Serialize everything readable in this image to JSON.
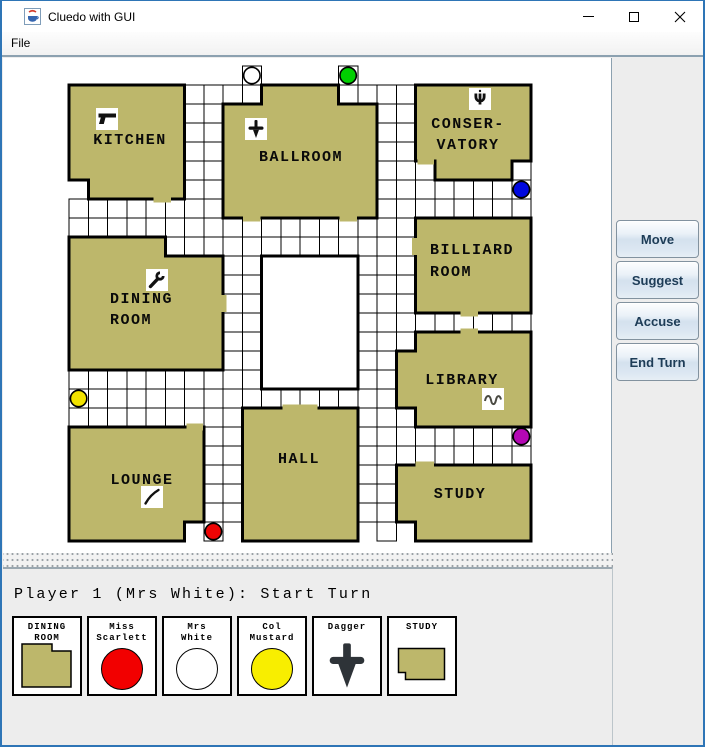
{
  "window": {
    "title": "Cluedo with GUI"
  },
  "menu": {
    "items": [
      {
        "label": "File"
      }
    ]
  },
  "action_panel": {
    "buttons": [
      {
        "label": "Move"
      },
      {
        "label": "Suggest"
      },
      {
        "label": "Accuse"
      },
      {
        "label": "End Turn"
      }
    ]
  },
  "status_bar": {
    "text": "Player 1 (Mrs White): Start Turn"
  },
  "colors": {
    "room_fill": "#bdb76b",
    "grid_line": "#000000",
    "window_border": "#2e75b6",
    "button_text": "#1d3c57",
    "dagger_card": "#2e3338"
  },
  "board": {
    "cell_size": [
      19.25,
      19.0
    ],
    "origin_svg": [
      66,
      8
    ],
    "corridor_rows": {
      "0": [
        [
          9,
          9
        ],
        [
          14,
          14
        ]
      ],
      "1": [
        [
          6,
          9
        ],
        [
          14,
          17
        ]
      ],
      "2": [
        [
          6,
          7
        ],
        [
          16,
          17
        ]
      ],
      "3": [
        [
          6,
          7
        ],
        [
          16,
          17
        ]
      ],
      "4": [
        [
          6,
          7
        ],
        [
          16,
          17
        ]
      ],
      "5": [
        [
          6,
          7
        ],
        [
          16,
          18
        ],
        [
          23,
          23
        ]
      ],
      "6": [
        [
          6,
          7
        ],
        [
          16,
          23
        ]
      ],
      "7": [
        [
          0,
          7
        ],
        [
          16,
          23
        ]
      ],
      "8": [
        [
          0,
          17
        ]
      ],
      "9": [
        [
          5,
          17
        ]
      ],
      "10": [
        [
          8,
          9
        ],
        [
          15,
          17
        ]
      ],
      "11": [
        [
          8,
          9
        ],
        [
          15,
          17
        ]
      ],
      "12": [
        [
          8,
          9
        ],
        [
          15,
          17
        ]
      ],
      "13": [
        [
          8,
          9
        ],
        [
          15,
          23
        ]
      ],
      "14": [
        [
          8,
          9
        ],
        [
          15,
          17
        ]
      ],
      "15": [
        [
          8,
          9
        ],
        [
          15,
          16
        ]
      ],
      "16": [
        [
          0,
          9
        ],
        [
          15,
          16
        ]
      ],
      "17": [
        [
          0,
          16
        ]
      ],
      "18": [
        [
          0,
          8
        ],
        [
          15,
          17
        ]
      ],
      "19": [
        [
          7,
          8
        ],
        [
          15,
          23
        ]
      ],
      "20": [
        [
          7,
          8
        ],
        [
          15,
          23
        ]
      ],
      "21": [
        [
          7,
          8
        ],
        [
          15,
          16
        ]
      ],
      "22": [
        [
          7,
          8
        ],
        [
          15,
          16
        ]
      ],
      "23": [
        [
          7,
          8
        ],
        [
          15,
          16
        ]
      ],
      "24": [
        [
          7,
          7
        ],
        [
          16,
          16
        ]
      ]
    },
    "rooms": [
      {
        "id": "kitchen",
        "label": [
          "KITCHEN"
        ],
        "label_pos": [
          127,
          86
        ],
        "anchor": "middle",
        "line_h": 21,
        "icon": {
          "name": "revolver",
          "cx": 104,
          "cy": 61
        },
        "poly": [
          [
            0,
            1
          ],
          [
            6,
            1
          ],
          [
            6,
            7
          ],
          [
            1,
            7
          ],
          [
            1,
            6
          ],
          [
            0,
            6
          ]
        ]
      },
      {
        "id": "ballroom",
        "label": [
          "BALLROOM"
        ],
        "label_pos": [
          298,
          103
        ],
        "anchor": "middle",
        "line_h": 21,
        "icon": {
          "name": "dagger",
          "cx": 253,
          "cy": 71
        },
        "poly": [
          [
            10,
            1
          ],
          [
            14,
            1
          ],
          [
            14,
            2
          ],
          [
            16,
            2
          ],
          [
            16,
            8
          ],
          [
            8,
            8
          ],
          [
            8,
            2
          ],
          [
            10,
            2
          ]
        ]
      },
      {
        "id": "conservatory",
        "label": [
          "CONSER-",
          "VATORY"
        ],
        "label_pos": [
          465,
          70
        ],
        "anchor": "middle",
        "line_h": 21,
        "icon": {
          "name": "candlestick",
          "cx": 477,
          "cy": 41
        },
        "poly": [
          [
            18,
            1
          ],
          [
            24,
            1
          ],
          [
            24,
            5
          ],
          [
            23,
            5
          ],
          [
            23,
            6
          ],
          [
            19,
            6
          ],
          [
            19,
            5
          ],
          [
            18,
            5
          ]
        ]
      },
      {
        "id": "dining-room",
        "label": [
          "DINING",
          "ROOM"
        ],
        "label_pos": [
          107,
          245
        ],
        "anchor": "start",
        "line_h": 21,
        "icon": {
          "name": "wrench",
          "cx": 154,
          "cy": 222
        },
        "poly": [
          [
            0,
            9
          ],
          [
            5,
            9
          ],
          [
            5,
            10
          ],
          [
            8,
            10
          ],
          [
            8,
            16
          ],
          [
            0,
            16
          ]
        ]
      },
      {
        "id": "billiard-room",
        "label": [
          "BILLIARD",
          "ROOM"
        ],
        "label_pos": [
          427,
          196
        ],
        "anchor": "start",
        "line_h": 22,
        "icon": null,
        "poly": [
          [
            18,
            8
          ],
          [
            24,
            8
          ],
          [
            24,
            13
          ],
          [
            18,
            13
          ]
        ]
      },
      {
        "id": "library",
        "label": [
          "LIBRARY"
        ],
        "label_pos": [
          459,
          326
        ],
        "anchor": "middle",
        "line_h": 21,
        "icon": {
          "name": "rope",
          "cx": 490,
          "cy": 341
        },
        "poly": [
          [
            18,
            14
          ],
          [
            24,
            14
          ],
          [
            24,
            19
          ],
          [
            18,
            19
          ],
          [
            18,
            18
          ],
          [
            17,
            18
          ],
          [
            17,
            15
          ],
          [
            18,
            15
          ]
        ]
      },
      {
        "id": "lounge",
        "label": [
          "LOUNGE"
        ],
        "label_pos": [
          139,
          426
        ],
        "anchor": "middle",
        "line_h": 21,
        "icon": {
          "name": "lead-pipe",
          "cx": 149,
          "cy": 439
        },
        "poly": [
          [
            0,
            19
          ],
          [
            7,
            19
          ],
          [
            7,
            24
          ],
          [
            6,
            24
          ],
          [
            6,
            25
          ],
          [
            0,
            25
          ]
        ]
      },
      {
        "id": "hall",
        "label": [
          "HALL"
        ],
        "label_pos": [
          296,
          405
        ],
        "anchor": "middle",
        "line_h": 21,
        "icon": null,
        "poly": [
          [
            9,
            18
          ],
          [
            15,
            18
          ],
          [
            15,
            25
          ],
          [
            9,
            25
          ]
        ]
      },
      {
        "id": "study",
        "label": [
          "STUDY"
        ],
        "label_pos": [
          457,
          440
        ],
        "anchor": "middle",
        "line_h": 21,
        "icon": null,
        "poly": [
          [
            17,
            21
          ],
          [
            24,
            21
          ],
          [
            24,
            25
          ],
          [
            18,
            25
          ],
          [
            18,
            24
          ],
          [
            17,
            24
          ]
        ]
      }
    ],
    "cellar_poly": [
      [
        10,
        10
      ],
      [
        15,
        10
      ],
      [
        15,
        17
      ],
      [
        10,
        17
      ]
    ],
    "doors": [
      [
        4.4,
        7,
        5.3,
        7
      ],
      [
        9.05,
        8,
        9.95,
        8
      ],
      [
        14.05,
        8,
        14.95,
        8
      ],
      [
        18.1,
        5,
        18.95,
        5
      ],
      [
        8,
        12.05,
        8,
        12.95
      ],
      [
        18,
        9.05,
        18,
        9.95
      ],
      [
        20.35,
        13,
        21.25,
        13
      ],
      [
        20.35,
        14,
        21.25,
        14
      ],
      [
        6.1,
        19,
        6.97,
        19
      ],
      [
        11.1,
        18,
        12.9,
        18
      ],
      [
        18.0,
        21,
        18.95,
        21
      ]
    ],
    "tokens": [
      {
        "name": "Mrs White",
        "row": 0,
        "col": 9,
        "color": "#ffffff"
      },
      {
        "name": "Rev Green",
        "row": 0,
        "col": 14,
        "color": "#00cf00"
      },
      {
        "name": "Mrs Peacock",
        "row": 6,
        "col": 23,
        "color": "#0008e0"
      },
      {
        "name": "Col Mustard",
        "row": 17,
        "col": 0,
        "color": "#f2e300"
      },
      {
        "name": "Prof Plum",
        "row": 19,
        "col": 23,
        "color": "#b408b4"
      },
      {
        "name": "Miss Scarlett",
        "row": 24,
        "col": 7,
        "color": "#ee0404"
      }
    ]
  },
  "hand": {
    "cards": [
      {
        "title": [
          "DINING",
          "ROOM"
        ],
        "kind": "room",
        "shape": "dining"
      },
      {
        "title": [
          "Miss",
          "Scarlett"
        ],
        "kind": "token",
        "color": "#f20000"
      },
      {
        "title": [
          "Mrs",
          "White"
        ],
        "kind": "token",
        "color": "#ffffff"
      },
      {
        "title": [
          "Col",
          "Mustard"
        ],
        "kind": "token",
        "color": "#f8ee00"
      },
      {
        "title": [
          "Dagger"
        ],
        "kind": "weapon",
        "weapon": "dagger"
      },
      {
        "title": [
          "STUDY"
        ],
        "kind": "room",
        "shape": "study"
      }
    ]
  }
}
